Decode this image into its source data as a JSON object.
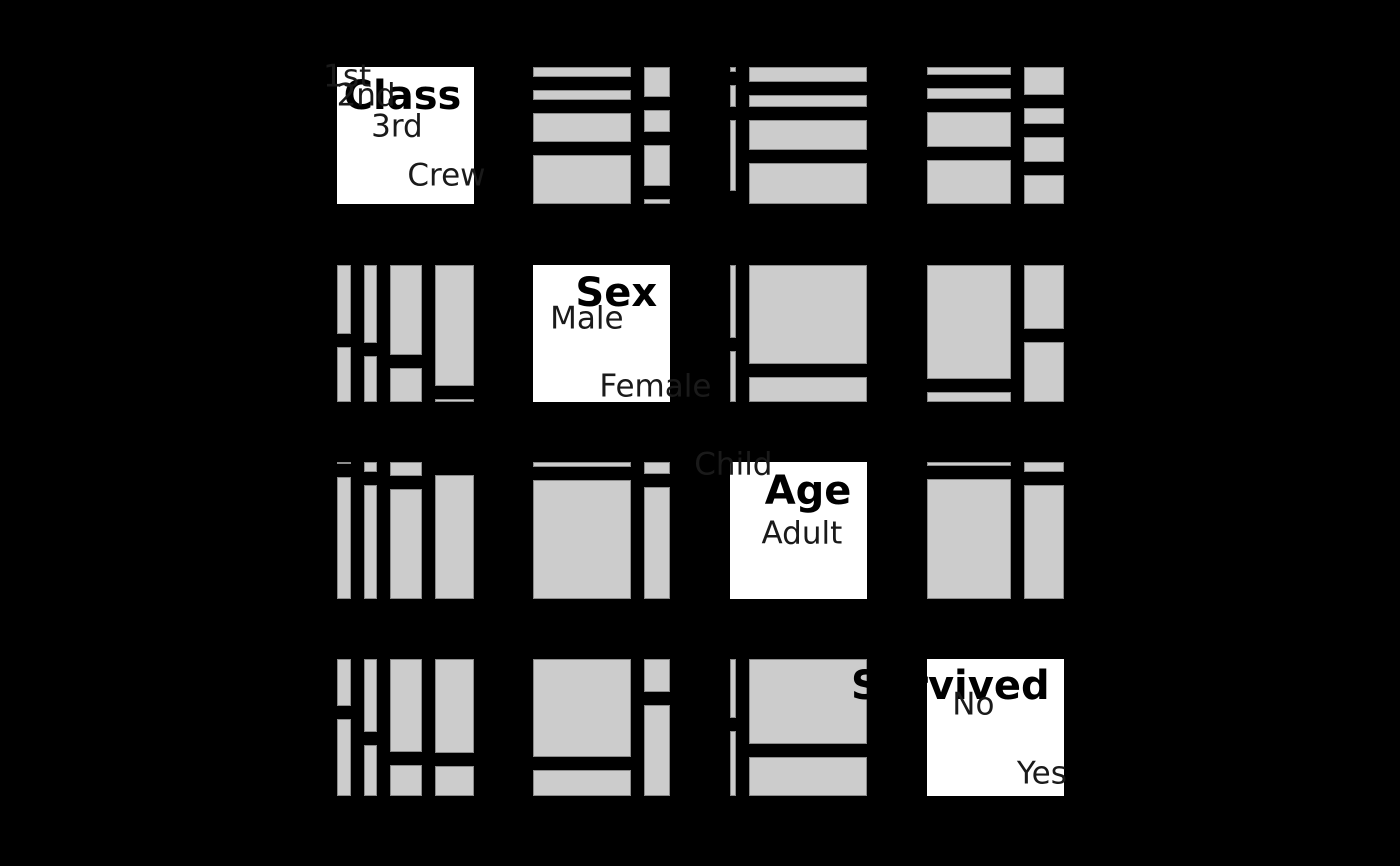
{
  "chart_data": {
    "type": "mosaic-pairs-matrix",
    "description": "Pairwise mosaic plot matrix of Titanic passenger counts; diagonal panels show variable names and category labels, off-diagonal panels show two-way mosaics (x split by column variable marginal, y split by row variable conditional on column variable).",
    "variables": [
      {
        "name": "Class",
        "categories": [
          "1st",
          "2nd",
          "3rd",
          "Crew"
        ]
      },
      {
        "name": "Sex",
        "categories": [
          "Male",
          "Female"
        ]
      },
      {
        "name": "Age",
        "categories": [
          "Child",
          "Adult"
        ]
      },
      {
        "name": "Survived",
        "categories": [
          "No",
          "Yes"
        ]
      }
    ],
    "total_count": 2201,
    "pairwise_counts": {
      "Class|Sex": [
        [
          180,
          145
        ],
        [
          179,
          106
        ],
        [
          510,
          196
        ],
        [
          862,
          23
        ]
      ],
      "Class|Age": [
        [
          6,
          319
        ],
        [
          24,
          261
        ],
        [
          79,
          627
        ],
        [
          0,
          885
        ]
      ],
      "Class|Survived": [
        [
          122,
          203
        ],
        [
          167,
          118
        ],
        [
          528,
          178
        ],
        [
          673,
          212
        ]
      ],
      "Sex|Age": [
        [
          64,
          1667
        ],
        [
          45,
          425
        ]
      ],
      "Sex|Survived": [
        [
          1364,
          367
        ],
        [
          126,
          344
        ]
      ],
      "Age|Survived": [
        [
          52,
          57
        ],
        [
          1438,
          654
        ]
      ]
    },
    "legend": "none",
    "axes": "none"
  },
  "layout": {
    "panel": {
      "xs": [
        337,
        533,
        730,
        927
      ],
      "ys": [
        67,
        265,
        462,
        659
      ],
      "size": 137,
      "tile_gap": 13
    },
    "colors": {
      "background": "#000000",
      "tile_fill": "#cccccc",
      "tile_border": "#8c8c8c",
      "diag_fill": "#ffffff",
      "title_text": "#000000",
      "label_text": "#1a1a1a"
    },
    "fonts": {
      "title_size": 40,
      "label_size": 31
    },
    "title_offsets": {
      "Class": [
        0.478,
        0.215
      ],
      "Sex": [
        0.608,
        0.205
      ],
      "Age": [
        0.57,
        0.215
      ],
      "Survived": [
        0.17,
        0.2
      ]
    }
  }
}
